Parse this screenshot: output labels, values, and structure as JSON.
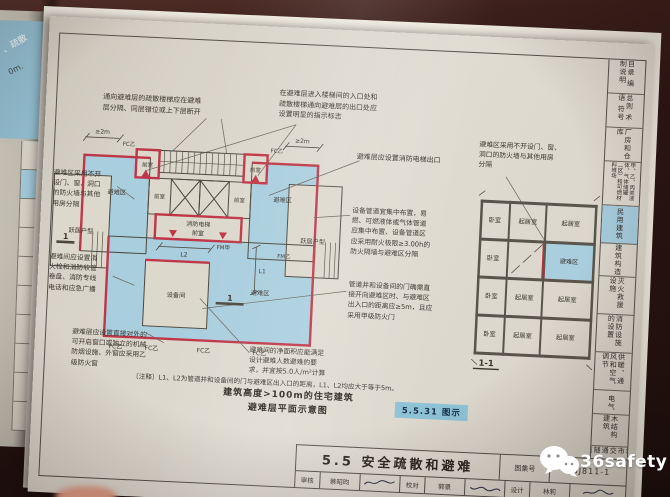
{
  "meta": {
    "page_number": "157"
  },
  "left_page": {
    "fragment1": "、疏散",
    "fragment2": "0m."
  },
  "sidebar": {
    "tabs": [
      {
        "label": "目录 编制说明",
        "active": false
      },
      {
        "label": "总则 术语 符号",
        "active": false
      },
      {
        "label": "厂房和仓库",
        "active": false
      },
      {
        "label": "甲、乙、丙类液体、气体储罐（区）和可燃材料堆场",
        "active": false
      },
      {
        "label": "民用建筑",
        "active": true
      },
      {
        "label": "建筑构造",
        "active": false
      },
      {
        "label": "灭火救援设施",
        "active": false
      },
      {
        "label": "消防设施的设置",
        "active": false
      },
      {
        "label": "供暖、通风和空气调节",
        "active": false
      },
      {
        "label": "电气",
        "active": false
      },
      {
        "label": "木结构建筑",
        "active": false
      },
      {
        "label": "城市交通隧道",
        "active": false
      }
    ]
  },
  "title_block": {
    "title": "5.5 安全疏散和避难",
    "atlas_label": "图集号",
    "atlas_no": "18J811-1",
    "signs": [
      {
        "label": "审核",
        "name": "蔡昭昀"
      },
      {
        "label": "校对",
        "name": "郭景"
      },
      {
        "label": "设计",
        "name": "林莉"
      }
    ]
  },
  "figure": {
    "caption": "建筑高度>100m的住宅建筑\n避难层平面示意图",
    "badge": "5.5.31 图示",
    "note": "〔注释〕L1、L2为管道井和设备间的门与避难区出入口的距离，L1、L2均应大于等于5m。",
    "annotations": {
      "stair_separate": "通向避难层的疏散楼梯应在避难\n层分隔、同层错位或上下层断开",
      "sign_mark": "在避难层进入楼梯间的入口处和\n疏散楼梯通向避难层的出口处应\n设置明显的指示标志",
      "fire_elevator_exit": "避难层应设置消防电梯出口",
      "firewall_left": "避难区采用不开\n设门、窗、洞口\n的防火墙与其他\n用房分隔",
      "hydrant": "避难间应设置消\n火栓和消防软管\n卷盘、消防专线\n电话和应急广播",
      "window_smoke": "避难层应设置直接对外的\n可开启窗口或独立的机械\n防烟设施、外窗应采用乙\n级防火窗",
      "net_area": "避难间的净面积应能满足\n设计避难人数避难的要\n求，并宜按5.0人/m²计算",
      "pipes": "设备管道宜集中布置，易\n燃、可燃液体或气体管道\n应集中布置、设备管道区\n应采用耐火极限≥3.00h的\n防火隔墙与避难区分隔",
      "pipe_door": "管道井和设备间的门确需直\n接开向避难区时、与避难区\n出入口的距离应≥5m，且应\n采用甲级防火门",
      "section_firewall": "避难区采用不开设门、窗、\n洞口的防火墙与其他用房\n分隔"
    },
    "plan_labels": {
      "refuge": "避难区",
      "duplex": "跃居户型",
      "front_room": "前室",
      "fire_elev1": "消防电梯",
      "fire_elev2": "前室",
      "equipment": "设备间",
      "fc": "FC乙",
      "fm_a": "FM甲",
      "fm_b": "FM乙",
      "dim2m": "≥2m",
      "l1": "L1",
      "l2": "L2",
      "cut": "1"
    },
    "section_labels": {
      "bedroom": "卧室",
      "living": "起居室",
      "refuge": "避难区",
      "mark": "1-1"
    }
  },
  "watermark": {
    "text": "36safety"
  },
  "colors": {
    "refuge_blue": "#a9cede",
    "wall_red": "#bf3648",
    "badge_bg": "#8fc2d6",
    "active_tab": "#a6cbdc",
    "line": "#4c4840"
  }
}
